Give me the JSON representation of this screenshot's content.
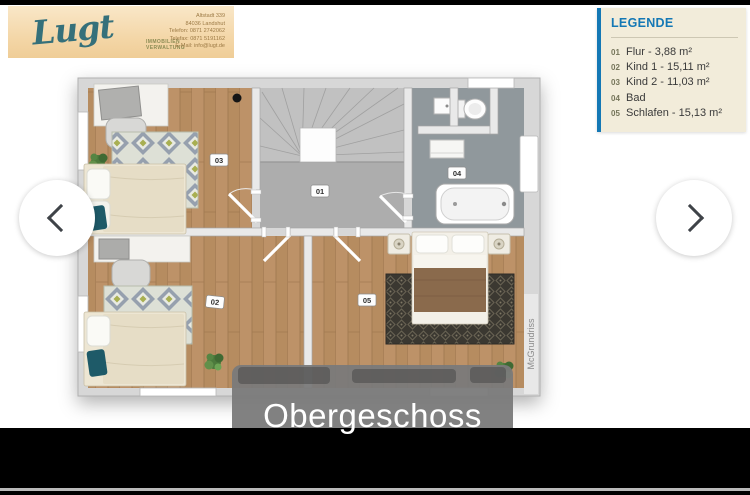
{
  "branding": {
    "logo_text": "Lugt",
    "logo_sub1": "IMMOBILIEN",
    "logo_sub2": "VERWALTUNG",
    "contact": [
      "Altstadt 339",
      "84036 Landshut",
      "Telefon: 0871 2742062",
      "Telefax: 0871 5191162",
      "E-Mail: info@lugt.de"
    ]
  },
  "legend": {
    "title": "LEGENDE",
    "items": [
      {
        "num": "01",
        "label": "Flur - 3,88 m²"
      },
      {
        "num": "02",
        "label": "Kind 1 - 15,11 m²"
      },
      {
        "num": "03",
        "label": "Kind 2 - 11,03 m²"
      },
      {
        "num": "04",
        "label": "Bad"
      },
      {
        "num": "05",
        "label": "Schlafen - 15,13 m²"
      }
    ]
  },
  "floorplan": {
    "labels": [
      "01",
      "02",
      "03",
      "04",
      "05"
    ],
    "watermark": "McGrundriss"
  },
  "viewer": {
    "caption": "Obergeschoss",
    "nav": {
      "prev_icon": "chevron-left",
      "next_icon": "chevron-right"
    }
  },
  "colors": {
    "accent_blue": "#1478b5",
    "legend_bg": "#f2ecda",
    "logo_bg": "#f4d7a8",
    "wood_floor": "#b98f63",
    "caption_overlay": "#7a7a7a"
  }
}
